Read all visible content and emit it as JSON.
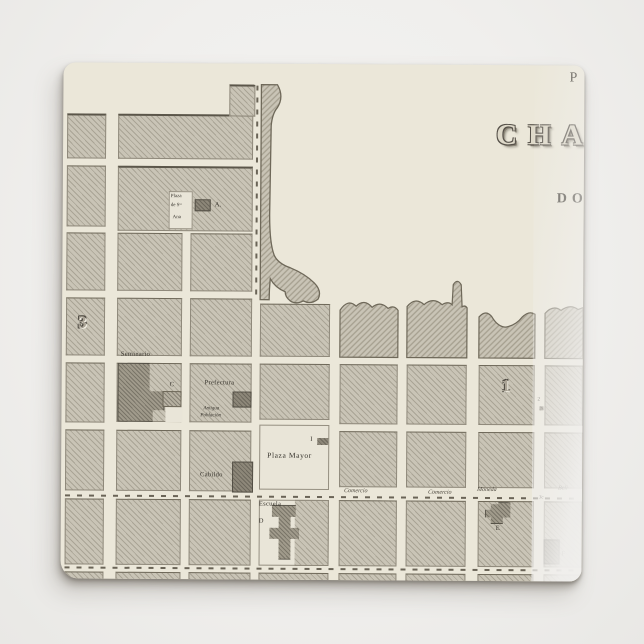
{
  "tile": {
    "title": {
      "fragment_top": "P",
      "fragment_main": "CHA",
      "fragment_sub": "DO"
    },
    "labels": {
      "plaza_sta_ana": [
        "Plaza",
        "de Sᵗᵃ",
        "Ana"
      ],
      "building_a": "A.",
      "district_3": "3",
      "seminario": "Seminario",
      "annex_c": "C",
      "prefectura": "Prefectura",
      "antigua": [
        "Antigua",
        "Población"
      ],
      "district_1": "1",
      "mark_2": "2",
      "cabildo": "Cabildo",
      "marker_i": "I",
      "plaza_mayor": "Plaza Mayor",
      "escuela": "Escuela",
      "building_d": "D",
      "building_e": "E",
      "building_f": "F",
      "mark_3c": "3c"
    },
    "streets": {
      "comercio_1": "Comercio",
      "comercio_2": "Comercio",
      "moneda": "Moneda",
      "beli": "Beli"
    }
  }
}
